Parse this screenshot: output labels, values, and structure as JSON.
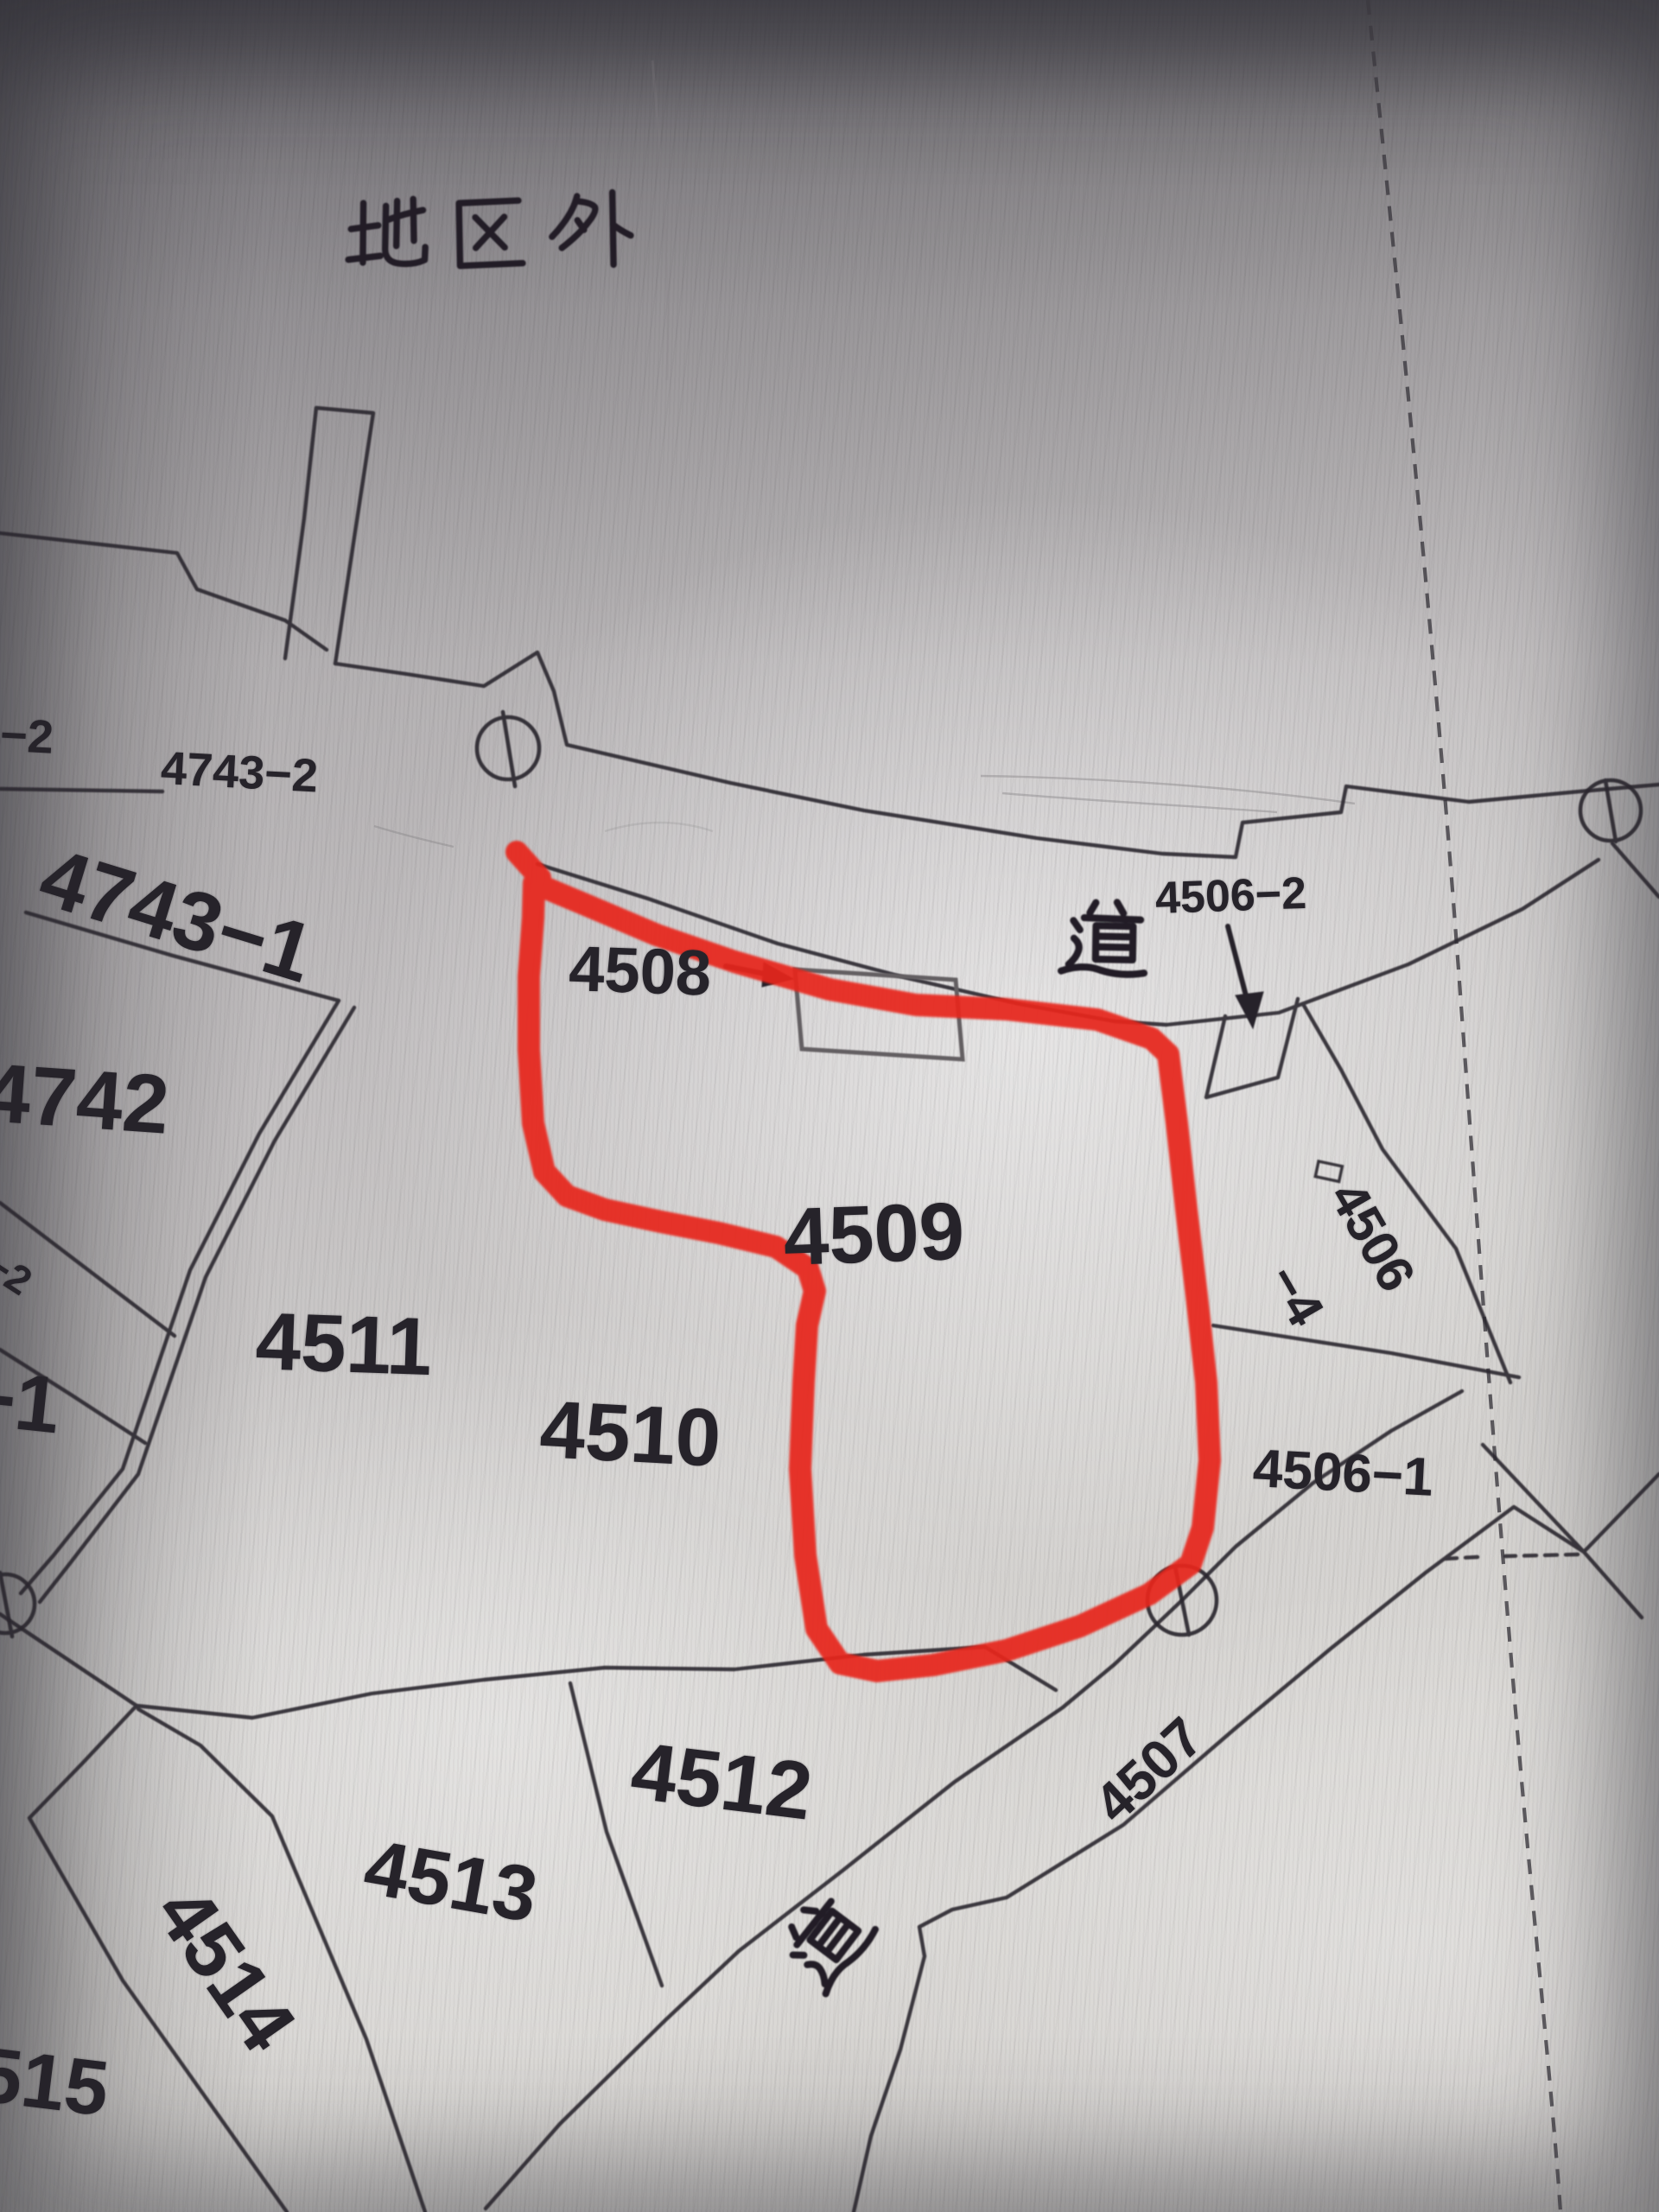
{
  "map": {
    "title": "cadastral-map-photo",
    "district_note": "地区外",
    "road_label_top": "道",
    "road_label_bottom": "道",
    "parcels": {
      "p4_2_partial": "4−2",
      "p4743_2": "4743−2",
      "p4743_1": "4743−1",
      "p4742": "4742",
      "p41_2": "41−2",
      "p_1": "−1",
      "p4511": "4511",
      "p4508": "4508",
      "p4509": "4509",
      "p4510": "4510",
      "p4506_2": "4506−2",
      "p4506_4a": "4506",
      "p4506_4b": "−4",
      "p4506_1": "4506−1",
      "p4507": "4507",
      "p4512": "4512",
      "p4513": "4513",
      "p4514": "4514",
      "p4515_partial": "515"
    },
    "icons": {
      "survey_marker": "circle-with-line",
      "small_square_marker": "open-square",
      "building": "tilted-rectangle-outline",
      "pointer_arrows": [
        "arrow-right-4508",
        "arrow-down-4506-2"
      ],
      "admin_boundary": "dashed-curved-line"
    },
    "colors": {
      "ink": "#26232a",
      "building_ink": "#635f62",
      "red_highlight": "#e7261b",
      "paper_light": "#d9d7d4",
      "paper_dark": "#98959a",
      "crease": "#8a8689"
    }
  }
}
